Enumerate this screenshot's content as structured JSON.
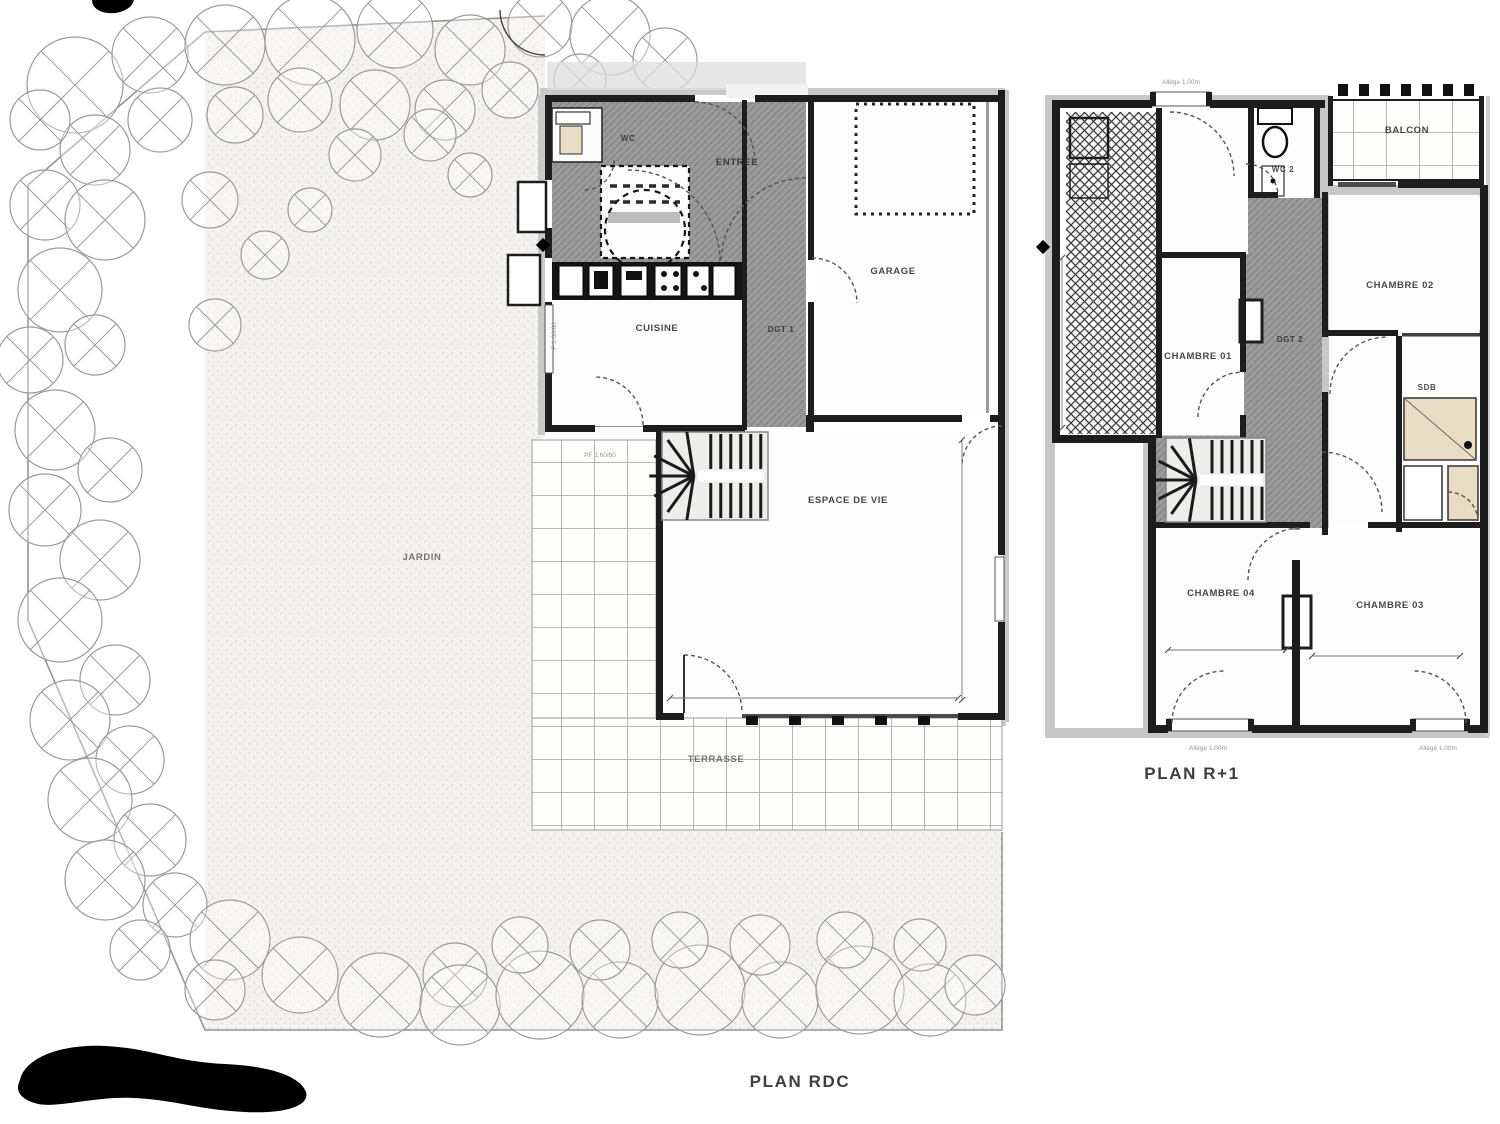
{
  "titles": {
    "rdc": "PLAN RDC",
    "r1": "PLAN R+1"
  },
  "rdc": {
    "wc": "WC",
    "entree": "ENTREE",
    "cuisine": "CUISINE",
    "dgt": "DGT 1",
    "garage": "GARAGE",
    "espace_de_vie": "ESPACE DE VIE",
    "jardin": "JARDIN",
    "terrasse": "TERRASSE"
  },
  "r1": {
    "wc2": "WC 2",
    "balcon": "BALCON",
    "chambre01": "CHAMBRE 01",
    "chambre02": "CHAMBRE 02",
    "sdb": "SDB",
    "dgt2": "DGT 2",
    "chambre04": "CHAMBRE 04",
    "chambre03": "CHAMBRE 03"
  },
  "notes": {
    "sill": "Allège 1.00m",
    "window_left": "F 1.00/60",
    "stair": "PF 1.60/60"
  },
  "colors": {
    "wall": "#1d1d1d",
    "hall_hatch": "#9b9b9b",
    "grid_line": "#a3a3a3",
    "garden_dot": "#d8d5cf",
    "title_text": "#333333",
    "fixture_beige": "#e8dcc4"
  }
}
